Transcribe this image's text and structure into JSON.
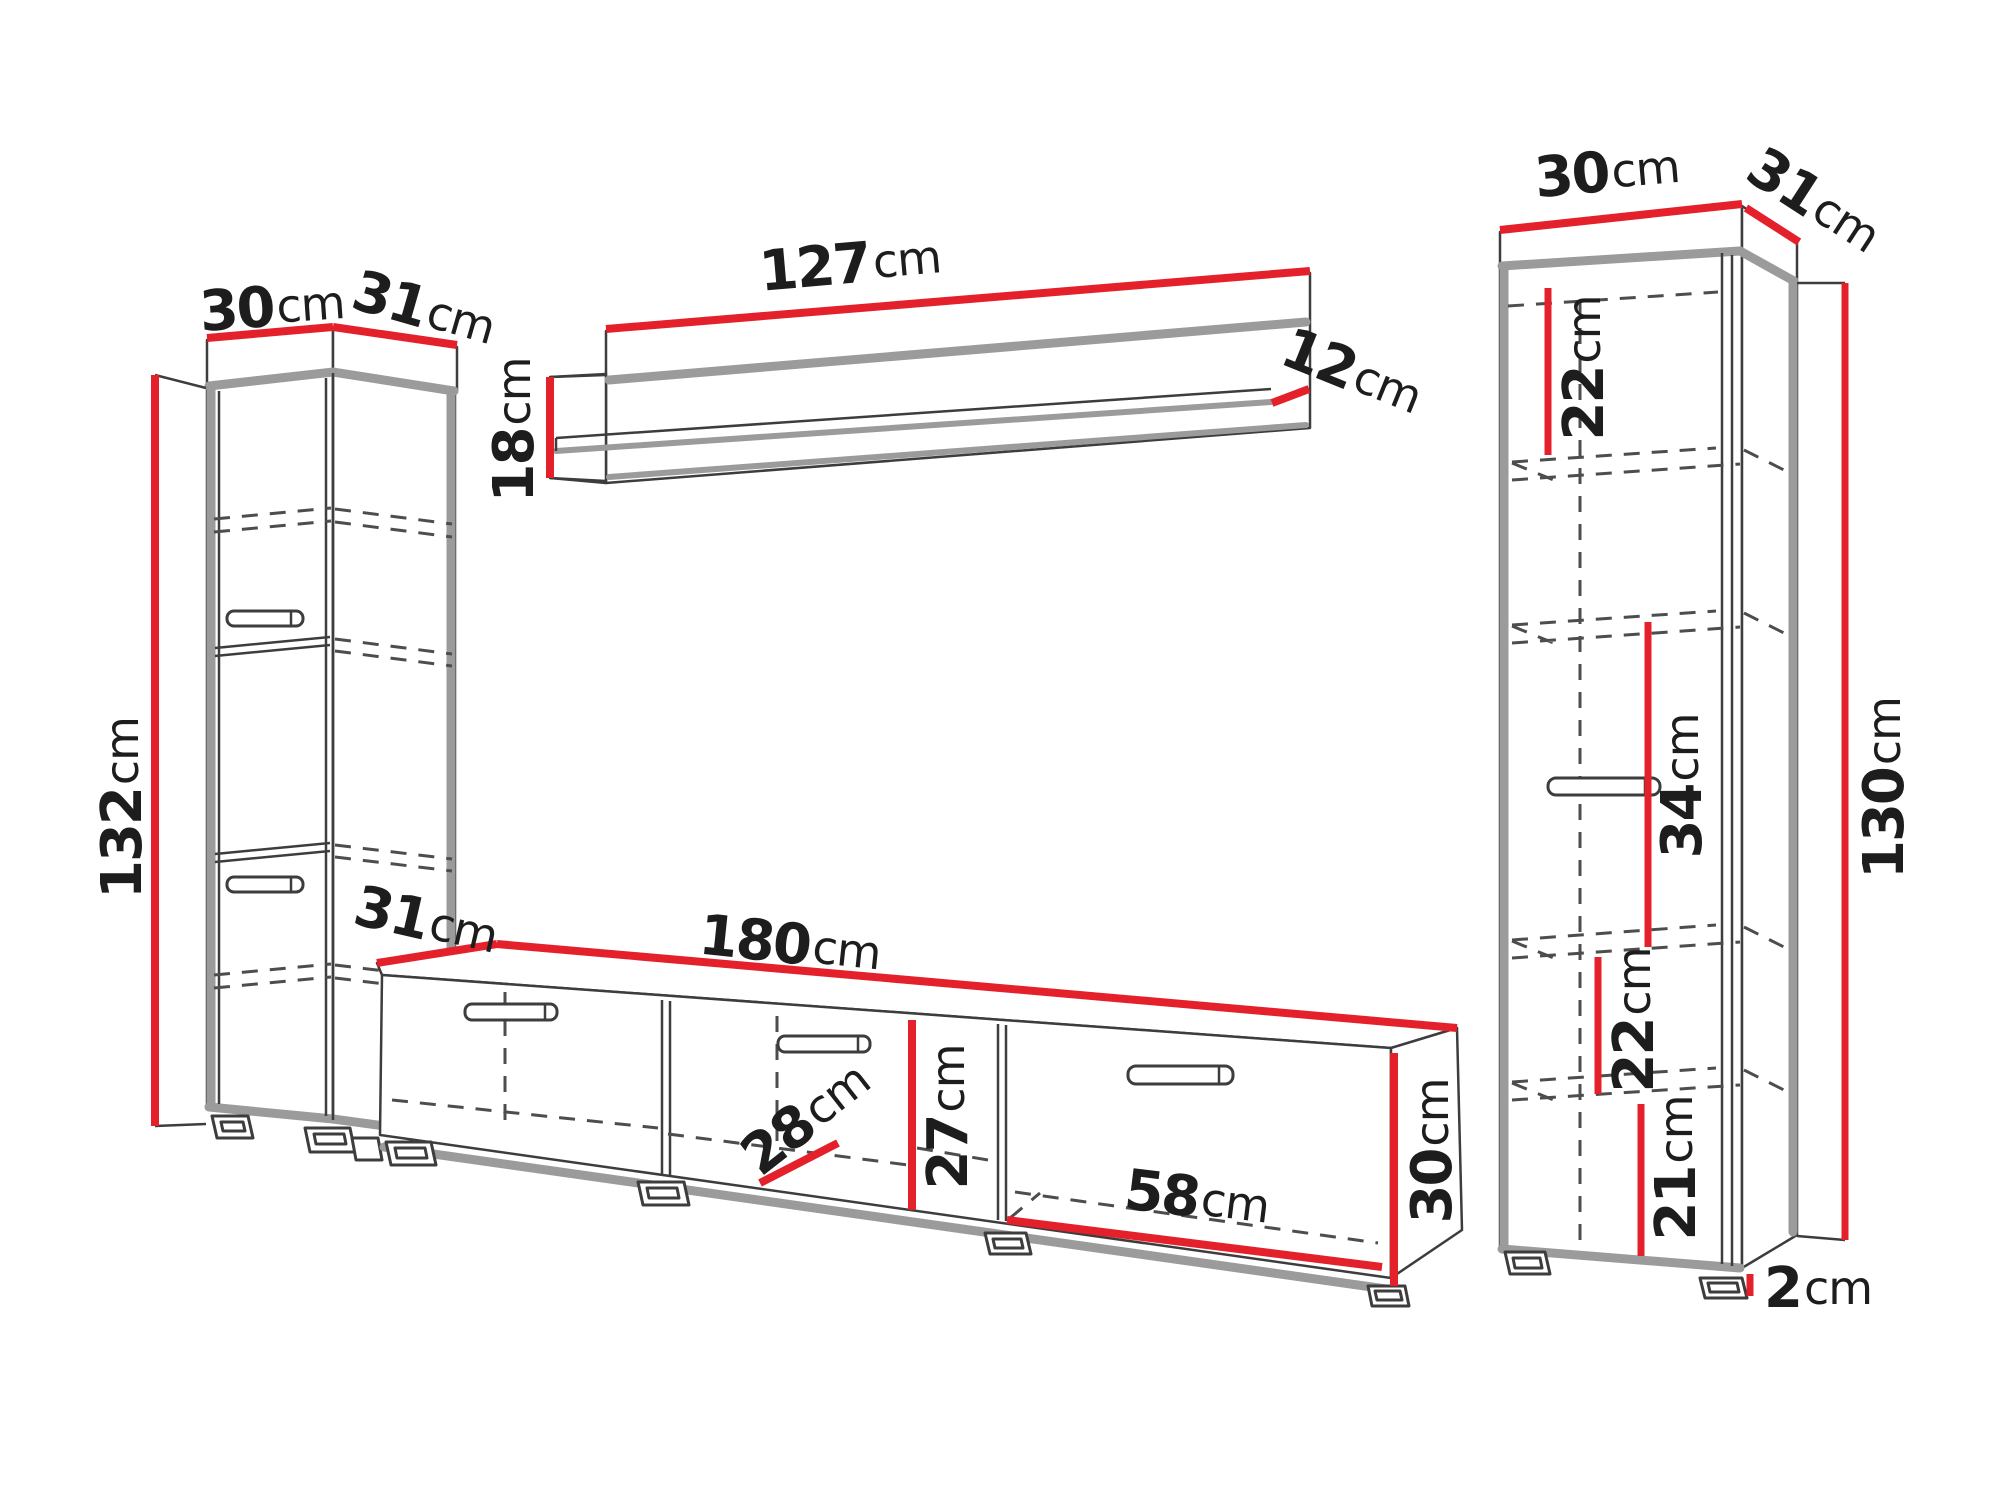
{
  "diagram": {
    "type": "furniture-wall-unit-dimension-drawing",
    "colors": {
      "dimension_line": "#e4212b",
      "outline": "#3d3d3d",
      "panel_gray": "#9b9b9b",
      "text": "#1d1d1d",
      "background": "#ffffff"
    }
  },
  "pieces": {
    "left_column": {
      "width": {
        "value": "30",
        "unit": "cm"
      },
      "depth": {
        "value": "31",
        "unit": "cm"
      },
      "height": {
        "value": "132",
        "unit": "cm"
      }
    },
    "wall_shelf": {
      "width": {
        "value": "127",
        "unit": "cm"
      },
      "depth": {
        "value": "12",
        "unit": "cm"
      },
      "height": {
        "value": "18",
        "unit": "cm"
      }
    },
    "tv_stand": {
      "depth": {
        "value": "31",
        "unit": "cm"
      },
      "width": {
        "value": "180",
        "unit": "cm"
      },
      "inner_depth": {
        "value": "28",
        "unit": "cm"
      },
      "inner_height": {
        "value": "27",
        "unit": "cm"
      },
      "inner_width": {
        "value": "58",
        "unit": "cm"
      },
      "height": {
        "value": "30",
        "unit": "cm"
      }
    },
    "right_column": {
      "width": {
        "value": "30",
        "unit": "cm"
      },
      "depth": {
        "value": "31",
        "unit": "cm"
      },
      "shelf_top": {
        "value": "22",
        "unit": "cm"
      },
      "shelf_middle": {
        "value": "34",
        "unit": "cm"
      },
      "height": {
        "value": "130",
        "unit": "cm"
      },
      "shelf_lower": {
        "value": "22",
        "unit": "cm"
      },
      "shelf_bottom": {
        "value": "21",
        "unit": "cm"
      },
      "plinth": {
        "value": "2",
        "unit": "cm"
      }
    }
  }
}
